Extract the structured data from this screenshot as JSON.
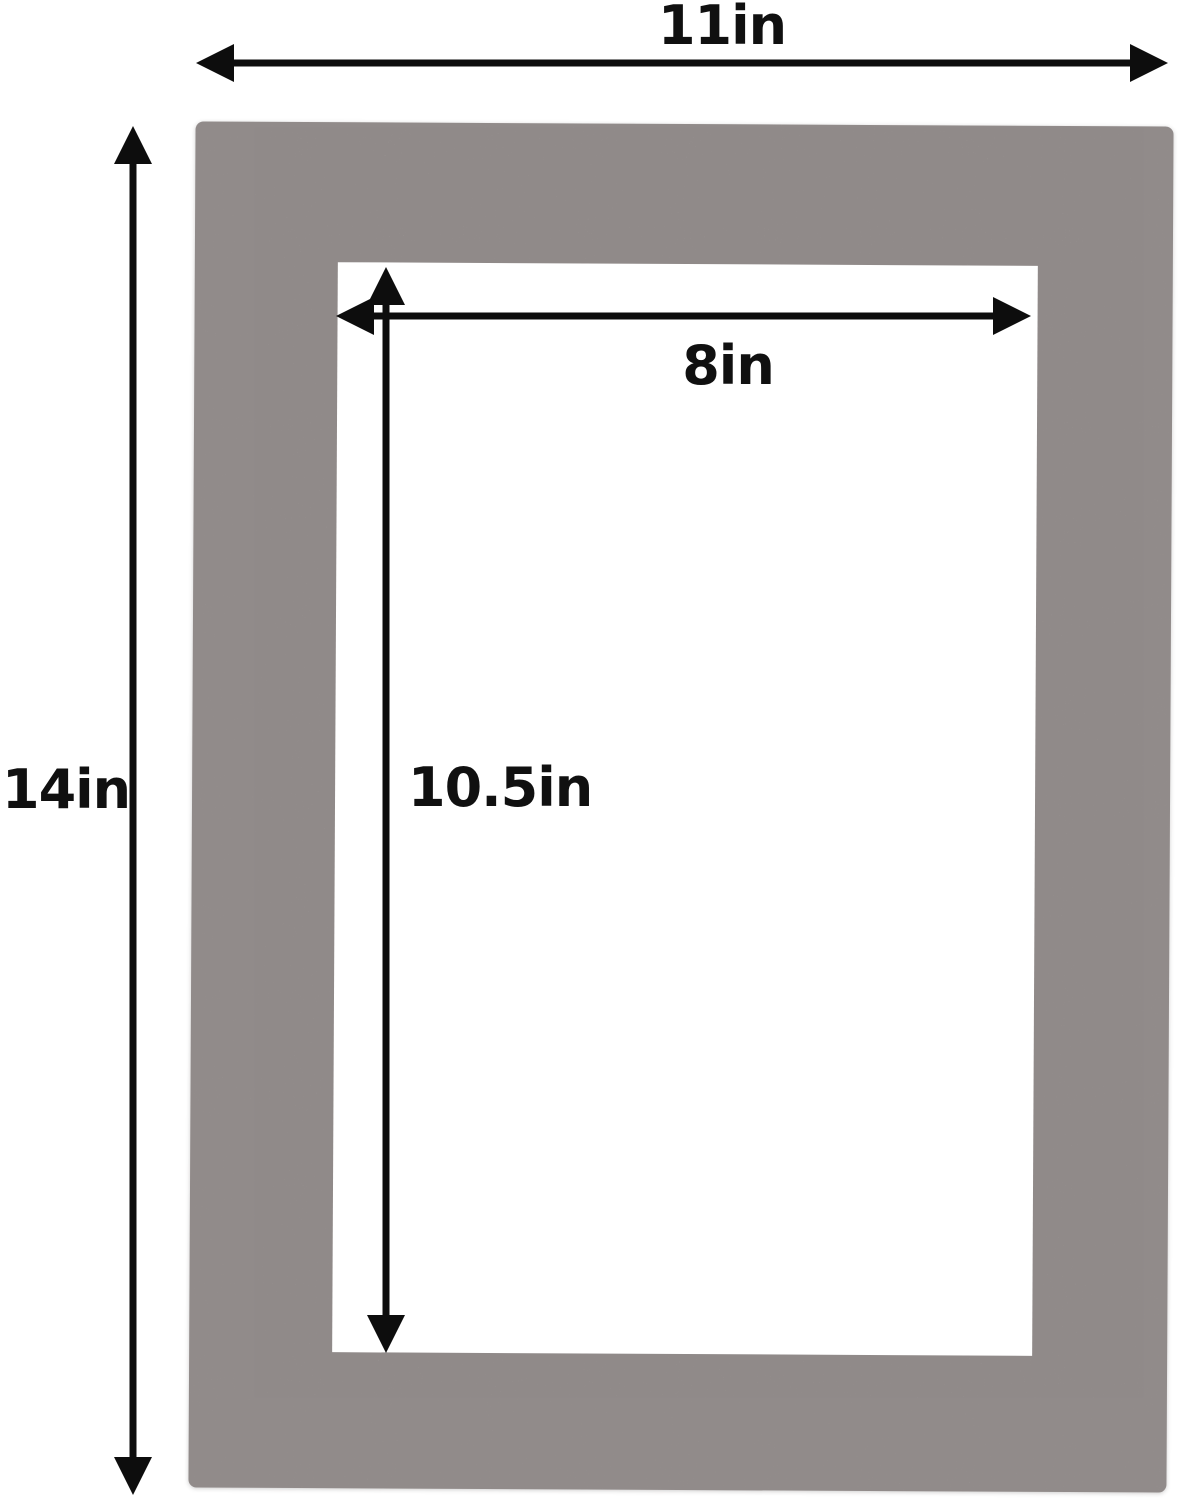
{
  "dimensions": {
    "outer_width": {
      "label": "11in",
      "value": 11,
      "unit": "in"
    },
    "outer_height": {
      "label": "14in",
      "value": 14,
      "unit": "in"
    },
    "opening_width": {
      "label": "8in",
      "value": 8,
      "unit": "in"
    },
    "opening_height": {
      "label": "10.5in",
      "value": 10.5,
      "unit": "in"
    }
  },
  "colors": {
    "mat": "#a9a2a1",
    "opening": "#ffffff",
    "background": "#ffffff",
    "dimension_lines": "#0d0d0d",
    "label_text": "#101010"
  }
}
